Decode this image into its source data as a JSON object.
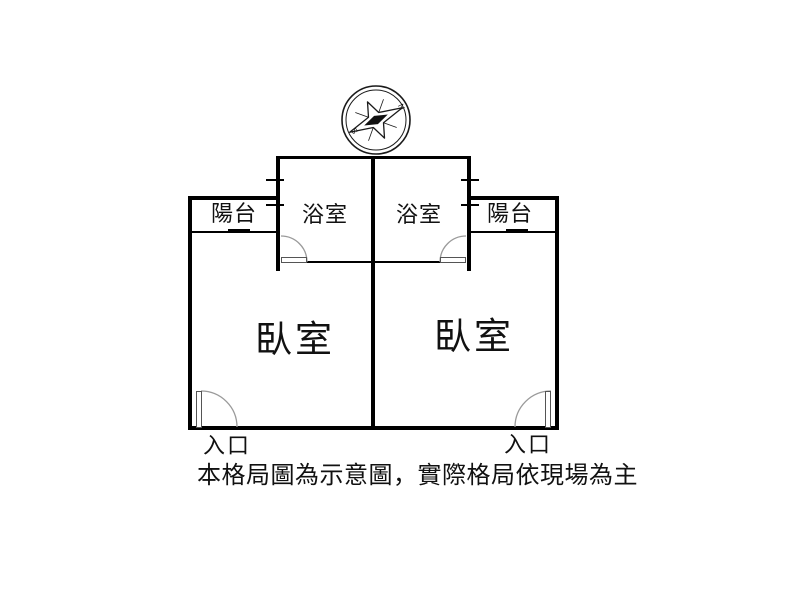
{
  "colors": {
    "background": "#ffffff",
    "wall": "#000000",
    "door_arc": "#9a9a9a",
    "text": "#111111"
  },
  "compass": {
    "north_label": "N",
    "south_label": "S"
  },
  "units": {
    "left": {
      "balcony": "陽台",
      "bathroom": "浴室",
      "bedroom": "臥室",
      "entrance": "入口"
    },
    "right": {
      "balcony": "陽台",
      "bathroom": "浴室",
      "bedroom": "臥室",
      "entrance": "入口"
    }
  },
  "disclaimer": "本格局圖為示意圖，實際格局依現場為主"
}
